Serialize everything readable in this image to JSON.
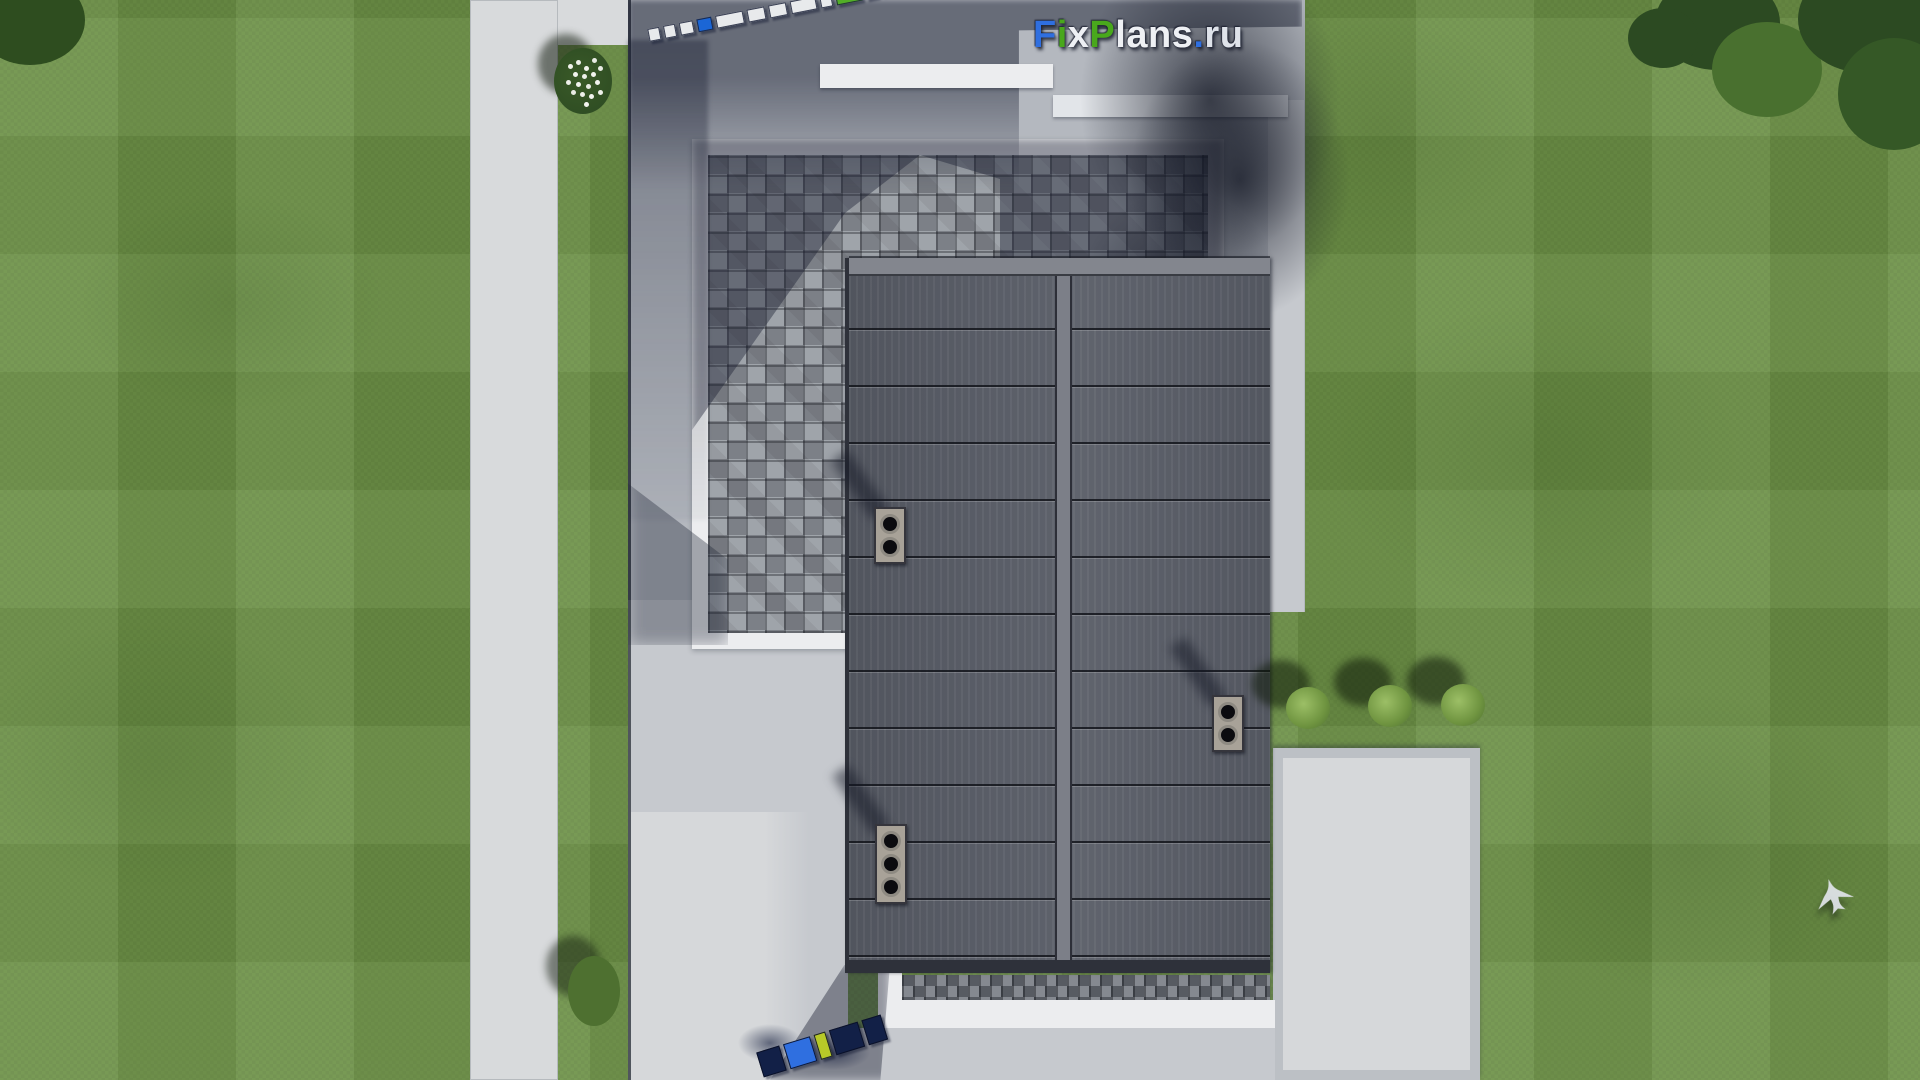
{
  "palette": {
    "grass": "#6d9147",
    "sidewalk": "#d8dadc",
    "concrete": "#b4b8bf",
    "stone": "#c6c9ce",
    "slab": "#d6d8da",
    "white-trim": "#ecedef",
    "paver": "#8d929a",
    "roof": "#585c66",
    "roof-trim": "#83868e",
    "roof-edge": "#2e313a",
    "accent-blue": "#1b66d6",
    "accent-green": "#52ae27",
    "logo-blue": "#2f6fe0",
    "logo-green": "#49a81c"
  },
  "watermark": {
    "text": "FixPlans.ru",
    "letters": [
      {
        "ch": "F",
        "color": "#2f6fe0"
      },
      {
        "ch": "i",
        "color": "#49a81c"
      },
      {
        "ch": "x",
        "color": "#eef0f4"
      },
      {
        "ch": "P",
        "color": "#49a81c"
      },
      {
        "ch": "l",
        "color": "#eef0f4"
      },
      {
        "ch": "a",
        "color": "#eef0f4"
      },
      {
        "ch": "n",
        "color": "#eef0f4"
      },
      {
        "ch": "s",
        "color": "#eef0f4"
      },
      {
        "ch": ".",
        "color": "#2f6fe0"
      },
      {
        "ch": "r",
        "color": "#dfe3ea"
      },
      {
        "ch": "u",
        "color": "#dfe3ea"
      }
    ]
  },
  "scale_bar_top": {
    "segments": [
      {
        "w": 10,
        "color": "#e8eaec"
      },
      {
        "w": 10,
        "color": "#e8eaec"
      },
      {
        "w": 12,
        "color": "#e8eaec"
      },
      {
        "w": 13,
        "color": "#1b66d6"
      },
      {
        "w": 26,
        "color": "#e8eaec"
      },
      {
        "w": 16,
        "color": "#e8eaec"
      },
      {
        "w": 16,
        "color": "#e8eaec"
      },
      {
        "w": 24,
        "color": "#e8eaec"
      },
      {
        "w": 10,
        "color": "#e8eaec"
      },
      {
        "w": 24,
        "color": "#52ae27"
      },
      {
        "w": 10,
        "color": "#e8eaec"
      },
      {
        "w": 20,
        "h": 16,
        "color": "#1b66d6"
      }
    ]
  },
  "scale_bar_bottom": {
    "segments": [
      {
        "w": 22,
        "color": "#122047"
      },
      {
        "w": 26,
        "color": "#2f6fe0"
      },
      {
        "w": 10,
        "color": "#b7c928"
      },
      {
        "w": 28,
        "color": "#122047"
      },
      {
        "w": 18,
        "color": "#122047"
      }
    ]
  },
  "chimneys": [
    {
      "vents": [
        1,
        2
      ]
    },
    {
      "vents": [
        1,
        2
      ]
    },
    {
      "vents": [
        1,
        2,
        3
      ]
    }
  ]
}
